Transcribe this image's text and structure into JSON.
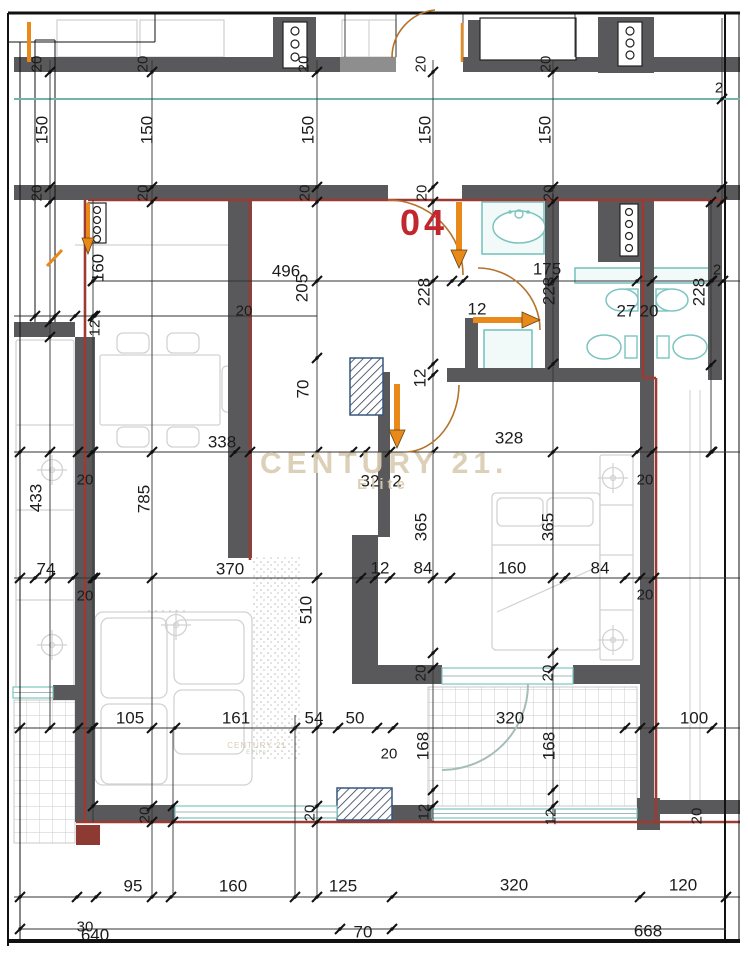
{
  "unit": {
    "number": "04"
  },
  "watermark": {
    "line1": "CENTURY 21.",
    "line2": "Elite",
    "small1": "CENTURY 21",
    "small2": "Elite"
  },
  "colors": {
    "wall": "#59595b",
    "wall_light": "#8e8e8e",
    "red": "#9c3a33",
    "red_fill": "#8d3a32",
    "orange": "#e8891a",
    "orange_dark": "#5f4410",
    "arc": "#b5722a",
    "teal": "#7cc4c0",
    "teal_line": "#74b5a8",
    "dim": "#333333",
    "text": "#1c1c1c",
    "furn": "#d2d2d2",
    "hatch": "#35567e",
    "gray_arc": "#a5bdb9"
  },
  "dimension_labels": [
    [
      "150",
      42,
      130,
      1
    ],
    [
      "150",
      147,
      130,
      1
    ],
    [
      "150",
      308,
      130,
      1
    ],
    [
      "150",
      425,
      130,
      1
    ],
    [
      "150",
      545,
      130,
      1
    ],
    [
      "20",
      37,
      64,
      1,
      15
    ],
    [
      "20",
      143,
      64,
      1,
      15
    ],
    [
      "20",
      304,
      64,
      1,
      15
    ],
    [
      "20",
      421,
      64,
      1,
      15
    ],
    [
      "20",
      546,
      64,
      1,
      15
    ],
    [
      "20",
      37,
      193,
      1,
      15
    ],
    [
      "20",
      143,
      193,
      1,
      15
    ],
    [
      "20",
      305,
      193,
      1,
      15
    ],
    [
      "20",
      422,
      193,
      1,
      15
    ],
    [
      "20",
      549,
      193,
      1,
      15
    ],
    [
      "2",
      719,
      88,
      0,
      15
    ],
    [
      "2",
      717,
      270,
      0,
      15
    ],
    [
      "496",
      286,
      271,
      0
    ],
    [
      "205",
      302,
      288,
      1
    ],
    [
      "228",
      424,
      292,
      1
    ],
    [
      "175",
      547,
      269,
      0
    ],
    [
      "228",
      549,
      291,
      1
    ],
    [
      "228",
      699,
      292,
      1
    ],
    [
      "12",
      477,
      309,
      0
    ],
    [
      "27",
      626,
      311,
      0
    ],
    [
      "20",
      649,
      311,
      0
    ],
    [
      "70",
      303,
      389,
      1
    ],
    [
      "12",
      420,
      378,
      1
    ],
    [
      "20",
      244,
      311,
      0,
      15
    ],
    [
      "160",
      98,
      268,
      1
    ],
    [
      "12",
      95,
      328,
      1,
      15
    ],
    [
      "338",
      222,
      442,
      0
    ],
    [
      "328",
      509,
      438,
      0
    ],
    [
      "32",
      370,
      481,
      0
    ],
    [
      "2",
      397,
      481,
      0
    ],
    [
      "20",
      85,
      480,
      0,
      15
    ],
    [
      "20",
      645,
      480,
      0,
      15
    ],
    [
      "433",
      36,
      498,
      1
    ],
    [
      "785",
      144,
      499,
      1
    ],
    [
      "365",
      421,
      527,
      1
    ],
    [
      "365",
      548,
      527,
      1
    ],
    [
      "510",
      306,
      610,
      1
    ],
    [
      "74",
      46,
      569,
      0
    ],
    [
      "370",
      230,
      569,
      0
    ],
    [
      "12",
      380,
      568,
      0
    ],
    [
      "84",
      423,
      568,
      0
    ],
    [
      "160",
      512,
      568,
      0
    ],
    [
      "84",
      600,
      568,
      0
    ],
    [
      "20",
      85,
      596,
      0,
      15
    ],
    [
      "20",
      645,
      595,
      0,
      15
    ],
    [
      "20",
      421,
      673,
      1,
      15
    ],
    [
      "20",
      548,
      673,
      1,
      15
    ],
    [
      "105",
      130,
      718,
      0
    ],
    [
      "161",
      236,
      718,
      0
    ],
    [
      "54",
      314,
      718,
      0
    ],
    [
      "50",
      355,
      718,
      0
    ],
    [
      "320",
      510,
      718,
      0
    ],
    [
      "100",
      694,
      718,
      0
    ],
    [
      "168",
      423,
      746,
      1
    ],
    [
      "168",
      549,
      746,
      1
    ],
    [
      "20",
      389,
      754,
      0,
      15
    ],
    [
      "20",
      145,
      815,
      1,
      15
    ],
    [
      "20",
      310,
      813,
      1,
      15
    ],
    [
      "12",
      424,
      812,
      1,
      15
    ],
    [
      "12",
      551,
      817,
      1,
      15
    ],
    [
      "20",
      697,
      816,
      1,
      15
    ],
    [
      "95",
      133,
      886,
      0
    ],
    [
      "160",
      233,
      886,
      0
    ],
    [
      "125",
      343,
      886,
      0
    ],
    [
      "320",
      514,
      885,
      0
    ],
    [
      "120",
      683,
      885,
      0
    ],
    [
      "30",
      85,
      927,
      0,
      15
    ],
    [
      "640",
      95,
      935,
      0
    ],
    [
      "70",
      363,
      932,
      0
    ],
    [
      "668",
      648,
      931,
      0
    ]
  ],
  "plan": {
    "tiles": [
      [
        14,
        700,
        61,
        143
      ],
      [
        428,
        687,
        209,
        119
      ]
    ],
    "stipple": [
      [
        252,
        556,
        50,
        204
      ],
      [
        143,
        610,
        44,
        107
      ]
    ],
    "furniture_rects": [
      [
        100,
        355,
        120,
        70,
        2
      ],
      [
        117,
        333,
        32,
        20,
        6
      ],
      [
        167,
        333,
        32,
        20,
        6
      ],
      [
        117,
        427,
        32,
        20,
        6
      ],
      [
        167,
        427,
        32,
        20,
        6
      ],
      [
        222,
        366,
        16,
        46,
        5
      ],
      [
        95,
        612,
        157,
        173,
        8
      ],
      [
        101,
        618,
        66,
        80,
        8
      ],
      [
        101,
        704,
        66,
        80,
        8
      ],
      [
        174,
        620,
        70,
        64,
        8
      ],
      [
        174,
        690,
        70,
        64,
        8
      ],
      [
        492,
        493,
        108,
        157,
        4
      ],
      [
        497,
        498,
        46,
        28,
        5
      ],
      [
        547,
        498,
        46,
        28,
        5
      ],
      [
        600,
        455,
        33,
        205,
        2
      ],
      [
        16,
        340,
        58,
        348,
        2
      ],
      [
        342,
        20,
        54,
        37,
        0
      ],
      [
        57,
        20,
        80,
        37,
        0
      ],
      [
        140,
        20,
        84,
        37,
        0
      ]
    ],
    "furniture_lines": [
      [
        75,
        245,
        230,
        245
      ],
      [
        16,
        425,
        74,
        425
      ],
      [
        16,
        510,
        74,
        510
      ],
      [
        16,
        600,
        74,
        600
      ],
      [
        600,
        505,
        633,
        505
      ],
      [
        600,
        555,
        633,
        555
      ],
      [
        600,
        610,
        633,
        610
      ],
      [
        492,
        545,
        600,
        545
      ],
      [
        369,
        20,
        369,
        57
      ],
      [
        497,
        612,
        595,
        568
      ]
    ],
    "crosshairs": [
      [
        52,
        470
      ],
      [
        52,
        645
      ],
      [
        613,
        478
      ],
      [
        613,
        640
      ],
      [
        176,
        625
      ]
    ],
    "teal_rects": [
      [
        482,
        202,
        62,
        52
      ],
      [
        484,
        330,
        48,
        45
      ],
      [
        575,
        268,
        138,
        15
      ]
    ],
    "teal_small_rects": [
      [
        626,
        289,
        12,
        22
      ],
      [
        656,
        289,
        12,
        22
      ],
      [
        625,
        336,
        12,
        22
      ],
      [
        657,
        336,
        12,
        22
      ]
    ],
    "teal_ellipses": [
      [
        527,
        37,
        33,
        14
      ],
      [
        519,
        227,
        26,
        16
      ],
      [
        622,
        300,
        16,
        11
      ],
      [
        672,
        300,
        16,
        11
      ],
      [
        604,
        347,
        17,
        12
      ],
      [
        690,
        347,
        17,
        12
      ]
    ],
    "teal_circles": [
      [
        527,
        47,
        4
      ],
      [
        519,
        214,
        4
      ]
    ],
    "teal_dots": [
      [
        515,
        52
      ],
      [
        527,
        55
      ],
      [
        539,
        52
      ],
      [
        510,
        212
      ],
      [
        528,
        212
      ]
    ],
    "walls": [
      [
        14,
        57,
        326,
        15
      ],
      [
        340,
        57,
        56,
        15,
        "#8e8e8e"
      ],
      [
        463,
        57,
        277,
        15
      ],
      [
        273,
        17,
        43,
        55
      ],
      [
        598,
        17,
        56,
        56
      ],
      [
        468,
        20,
        14,
        40
      ],
      [
        14,
        185,
        374,
        15
      ],
      [
        462,
        185,
        278,
        15
      ],
      [
        14,
        322,
        61,
        15
      ],
      [
        228,
        200,
        24,
        358
      ],
      [
        75,
        337,
        20,
        485
      ],
      [
        640,
        200,
        14,
        622
      ],
      [
        708,
        200,
        14,
        180
      ],
      [
        545,
        200,
        14,
        180
      ],
      [
        465,
        318,
        13,
        62
      ],
      [
        447,
        368,
        193,
        14
      ],
      [
        378,
        372,
        12,
        165
      ],
      [
        352,
        535,
        26,
        133
      ],
      [
        352,
        665,
        90,
        19
      ],
      [
        573,
        665,
        67,
        19
      ],
      [
        598,
        198,
        50,
        64
      ],
      [
        75,
        805,
        100,
        17
      ],
      [
        337,
        805,
        95,
        17
      ],
      [
        637,
        798,
        23,
        32
      ],
      [
        660,
        800,
        80,
        14
      ],
      [
        53,
        685,
        22,
        15
      ]
    ],
    "boxes": [
      [
        480,
        18,
        96,
        42
      ],
      [
        283,
        22,
        24,
        46
      ],
      [
        88,
        203,
        18,
        40
      ],
      [
        618,
        22,
        24,
        44
      ],
      [
        620,
        204,
        18,
        52
      ]
    ],
    "box_circles": [
      [
        295,
        31,
        4
      ],
      [
        295,
        44,
        4
      ],
      [
        295,
        57,
        4
      ],
      [
        97,
        210,
        3.5
      ],
      [
        97,
        220,
        3.5
      ],
      [
        97,
        230,
        3.5
      ],
      [
        97,
        239,
        3.5
      ],
      [
        630,
        31,
        4
      ],
      [
        630,
        43,
        4
      ],
      [
        630,
        55,
        4
      ],
      [
        629,
        212,
        3.5
      ],
      [
        629,
        224,
        3.5
      ],
      [
        629,
        236,
        3.5
      ],
      [
        629,
        248,
        3.5
      ]
    ],
    "hatches": [
      [
        350,
        358,
        33,
        57
      ],
      [
        337,
        788,
        55,
        32
      ]
    ],
    "windows": [
      [
        13,
        687,
        40,
        11
      ],
      [
        175,
        806,
        162,
        12
      ],
      [
        432,
        809,
        205,
        9
      ],
      [
        442,
        668,
        131,
        16
      ]
    ],
    "red_lines": [
      [
        88,
        200,
        723,
        200
      ],
      [
        85,
        200,
        85,
        822
      ],
      [
        250,
        200,
        250,
        560
      ],
      [
        643,
        200,
        643,
        378
      ],
      [
        643,
        378,
        656,
        378
      ],
      [
        656,
        378,
        656,
        822
      ],
      [
        76,
        822,
        740,
        822
      ]
    ],
    "red_rects": [
      [
        76,
        825,
        24,
        20
      ]
    ],
    "frame_lines": [
      [
        8,
        13,
        740,
        13,
        3
      ],
      [
        8,
        13,
        8,
        946,
        2
      ],
      [
        8,
        941,
        740,
        941,
        4
      ],
      [
        725,
        13,
        725,
        941,
        2
      ],
      [
        739,
        13,
        739,
        941,
        1
      ],
      [
        20,
        42,
        20,
        941,
        1
      ],
      [
        8,
        42,
        155,
        42,
        1
      ],
      [
        155,
        13,
        155,
        42,
        1
      ],
      [
        35,
        40,
        35,
        322,
        1
      ],
      [
        55,
        40,
        55,
        322,
        1
      ],
      [
        35,
        40,
        55,
        40,
        1
      ],
      [
        345,
        14,
        345,
        57,
        0.8
      ],
      [
        396,
        14,
        396,
        57,
        0.8
      ],
      [
        463,
        14,
        463,
        57,
        0.8
      ],
      [
        575,
        14,
        575,
        57,
        0.8
      ],
      [
        690,
        390,
        690,
        800,
        1,
        "#cfcfcf"
      ],
      [
        700,
        390,
        700,
        800,
        1,
        "#cfcfcf"
      ]
    ],
    "teal_lines": [
      [
        14,
        99,
        740,
        99
      ]
    ],
    "dims_h": [
      {
        "y": 281,
        "x1": 93,
        "x2": 740,
        "t": [
          93,
          452,
          463,
          637,
          652,
          712,
          723
        ]
      },
      {
        "y": 316,
        "x1": 14,
        "x2": 317,
        "t": [
          35,
          55,
          75,
          95
        ]
      },
      {
        "y": 452,
        "x1": 14,
        "x2": 740,
        "t": [
          20,
          78,
          92,
          235,
          250,
          352,
          365,
          390,
          637,
          652,
          712
        ]
      },
      {
        "y": 578,
        "x1": 14,
        "x2": 740,
        "t": [
          20,
          35,
          73,
          95,
          361,
          375,
          390,
          450,
          565,
          625,
          640,
          654
        ]
      },
      {
        "y": 728,
        "x1": 14,
        "x2": 740,
        "t": [
          20,
          78,
          92,
          175,
          295,
          338,
          377,
          393,
          625,
          640,
          654,
          712
        ]
      },
      {
        "y": 897,
        "x1": 14,
        "x2": 740,
        "t": [
          20,
          77,
          96,
          171,
          295,
          392,
          640,
          726
        ]
      },
      {
        "y": 929,
        "x1": 20,
        "x2": 726,
        "t": [
          20,
          340,
          392
        ]
      }
    ],
    "dims_v": [
      {
        "x": 50,
        "y1": 60,
        "y2": 728,
        "t": [
          72,
          187,
          202,
          322,
          337,
          452,
          578,
          728
        ]
      },
      {
        "x": 93,
        "y1": 200,
        "y2": 822,
        "t": [
          281,
          316,
          452,
          578,
          728,
          806
        ]
      },
      {
        "x": 152,
        "y1": 60,
        "y2": 897,
        "t": [
          72,
          187,
          202,
          452,
          578,
          728,
          806,
          822,
          897
        ]
      },
      {
        "x": 317,
        "y1": 60,
        "y2": 897,
        "t": [
          72,
          187,
          202,
          281,
          358,
          452,
          578,
          728,
          806,
          822,
          897
        ]
      },
      {
        "x": 433,
        "y1": 60,
        "y2": 822,
        "t": [
          72,
          187,
          202,
          281,
          364,
          375,
          452,
          578,
          653,
          668,
          790,
          806
        ]
      },
      {
        "x": 553,
        "y1": 60,
        "y2": 822,
        "t": [
          72,
          187,
          202,
          281,
          364,
          452,
          578,
          653,
          668,
          790,
          806
        ]
      },
      {
        "x": 711,
        "y1": 200,
        "y2": 452,
        "t": [
          202,
          281,
          365,
          452
        ]
      },
      {
        "x": 722,
        "y1": 18,
        "y2": 202,
        "t": [
          99,
          187,
          202
        ]
      },
      {
        "x": 173,
        "y1": 728,
        "y2": 897,
        "t": [
          806,
          822
        ]
      },
      {
        "x": 295,
        "y1": 715,
        "y2": 897,
        "t": []
      }
    ],
    "arcs": [
      [
        "M388,200 A75,75 0 0 1 463,275",
        "#b5722a",
        1.6
      ],
      [
        "M478,268 A62,62 0 0 1 540,330",
        "#b5722a",
        1.6
      ],
      [
        "M459,385 A55,68 0 0 1 407,452",
        "#b5722a",
        1.6
      ],
      [
        "M435,10 A48,48 0 0 0 392,58",
        "#b5722a",
        1.6
      ],
      [
        "M528,684 A86,86 0 0 1 442,770",
        "#a5bdb9",
        2
      ]
    ],
    "arrows_thick": [
      {
        "l": [
          459,
          202,
          459,
          252
        ],
        "h": "451,250 467,250 459,268",
        "w": 6
      },
      {
        "l": [
          473,
          320,
          524,
          320
        ],
        "h": "522,312 522,328 540,320",
        "w": 6
      },
      {
        "l": [
          397,
          384,
          397,
          432
        ],
        "h": "389,430 405,430 397,448",
        "w": 6
      },
      {
        "l": [
          88,
          203,
          88,
          240
        ],
        "h": "82,238 94,238 88,254",
        "w": 4
      }
    ],
    "orange_lines": [
      [
        29,
        22,
        29,
        62,
        4
      ],
      [
        462,
        23,
        462,
        62,
        2.5
      ],
      [
        47,
        266,
        62,
        250,
        3
      ]
    ]
  }
}
